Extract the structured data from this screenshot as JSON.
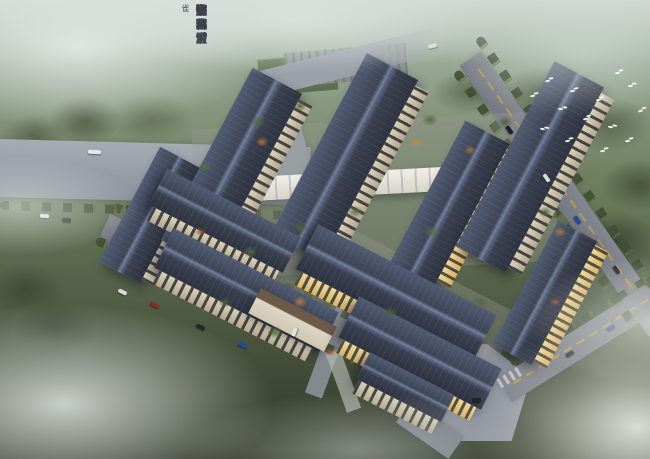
{
  "calligraphy": {
    "signature": "朱雀",
    "columns": [
      "难寻。",
      "烟雨渺",
      "变化，",
      "宇宙穷",
      "为深。",
      "怀古情",
      "女杰，",
      "忧时君",
      "子心。",
      "寄画尘",
      "中客，",
      "寻巷谊"
    ]
  },
  "palette": {
    "roof": "#414a5c",
    "roof_ridge": "#74809c",
    "facade": "#d2c6a8",
    "window_lit": "#e9c87e",
    "road": "#8d929c",
    "forest": "#5c684d",
    "mist": "#e6ece8",
    "ink": "#3e444b",
    "seal_red": "#b0453a"
  }
}
